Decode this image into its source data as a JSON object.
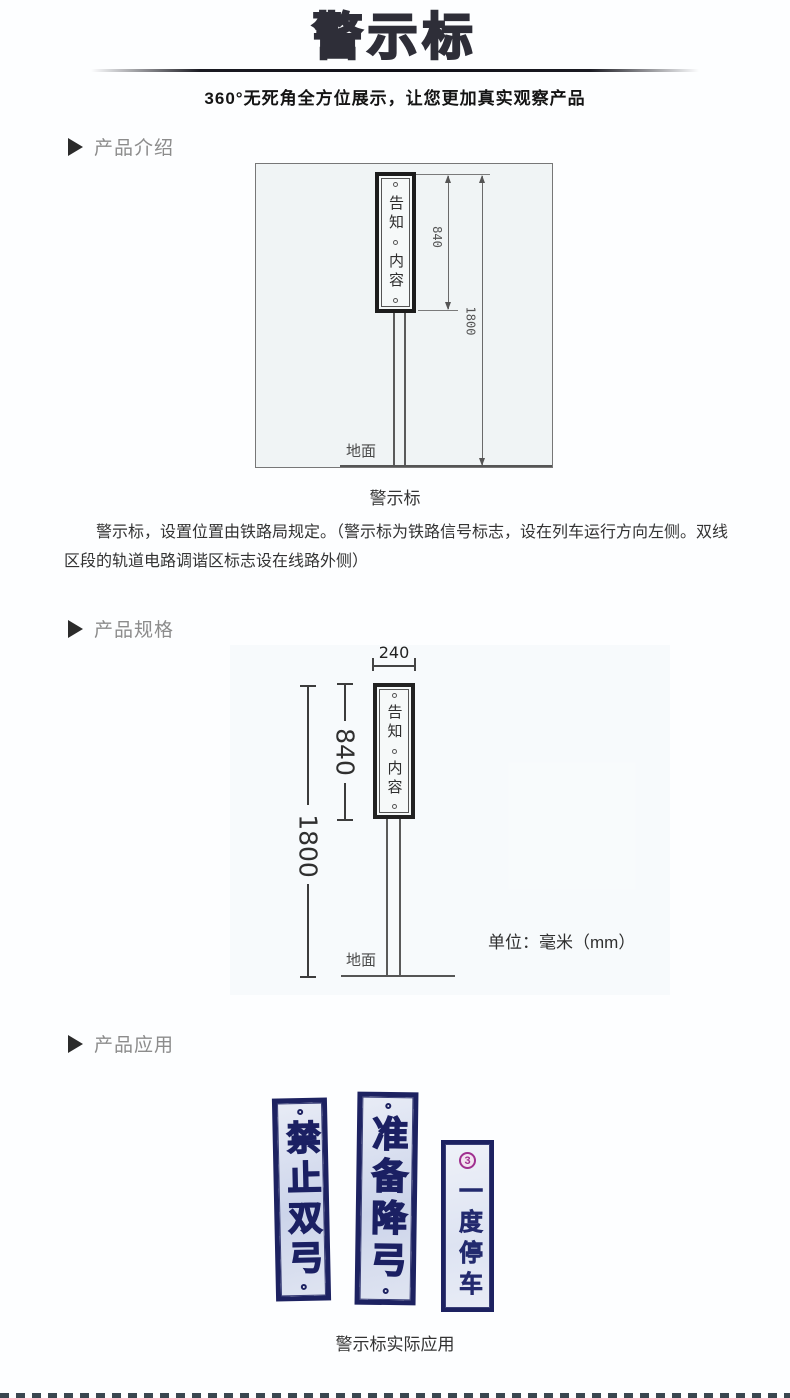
{
  "header": {
    "title": "警示标",
    "subtitle": "360°无死角全方位展示，让您更加真实观察产品"
  },
  "sections": {
    "intro": {
      "label": "产品介绍",
      "diagram": {
        "sign_text_top": "告知",
        "sign_text_bottom": "内容",
        "dim_sign_height": "840",
        "dim_total_height": "1800",
        "ground_label": "地面"
      },
      "diagram_caption": "警示标",
      "description": "警示标，设置位置由铁路局规定。（警示标为铁路信号标志，设在列车运行方向左侧。双线区段的轨道电路调谐区标志设在线路外侧）"
    },
    "specs": {
      "label": "产品规格",
      "diagram": {
        "dim_width": "240",
        "dim_sign_height": "840",
        "dim_total_height": "1800",
        "sign_text_top": "告知",
        "sign_text_bottom": "内容",
        "ground_label": "地面"
      },
      "unit_note": "单位：毫米（mm）"
    },
    "application": {
      "label": "产品应用",
      "signs": [
        {
          "text": "禁止双弓"
        },
        {
          "text": "准备降弓"
        },
        {
          "text": "一度停车",
          "emblem": "3"
        }
      ],
      "caption": "警示标实际应用"
    }
  },
  "colors": {
    "title_dark": "#2e2e38",
    "section_label_gray": "#8c8c8c",
    "sign_navy": "#1d2261",
    "sign_face_blue": "#ccd4ea",
    "emblem_purple": "#a03090",
    "diagram_scan_bg": "#f0f4f5"
  }
}
